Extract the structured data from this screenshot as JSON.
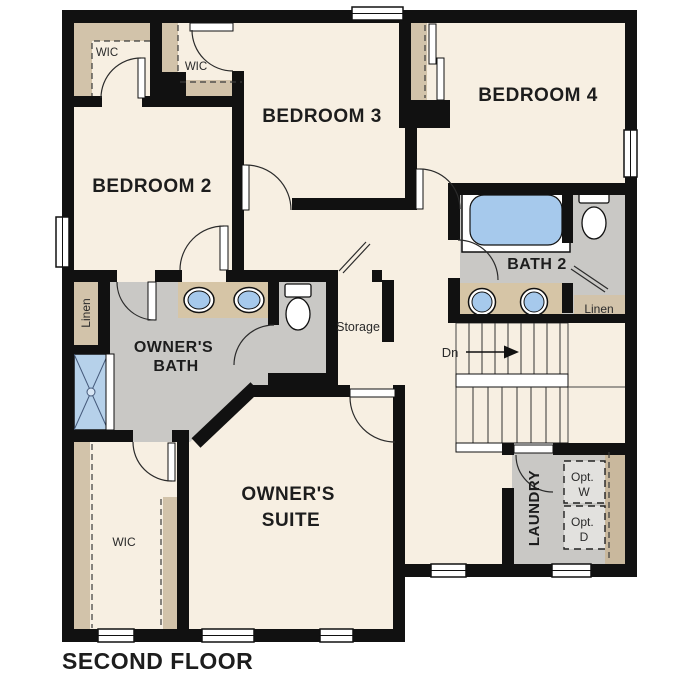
{
  "title": "SECOND FLOOR",
  "rooms": {
    "bedroom2": {
      "label": "BEDROOM 2"
    },
    "bedroom3": {
      "label": "BEDROOM 3"
    },
    "bedroom4": {
      "label": "BEDROOM 4"
    },
    "owners_suite": {
      "line1": "OWNER'S",
      "line2": "SUITE"
    },
    "owners_bath": {
      "line1": "OWNER'S",
      "line2": "BATH"
    },
    "bath2": {
      "label": "BATH 2"
    },
    "laundry": {
      "label": "LAUNDRY"
    },
    "storage": {
      "label": "Storage"
    },
    "wic_bedroom2": {
      "label": "WIC"
    },
    "wic_bedroom3": {
      "label": "WIC"
    },
    "wic_owners": {
      "label": "WIC"
    },
    "linen_owners": {
      "label": "Linen"
    },
    "linen_bath2": {
      "label": "Linen"
    },
    "stairs": {
      "down_label": "Dn"
    },
    "opt_washer": {
      "line1": "Opt.",
      "line2": "W"
    },
    "opt_dryer": {
      "line1": "Opt.",
      "line2": "D"
    }
  },
  "colors": {
    "wall": "#111111",
    "floor_beige": "#f7efe2",
    "wet_area_gray": "#c9c8c5",
    "closet_tan": "#d2c3aa",
    "counter_tan": "#d6c5a6",
    "fixture_blue": "#a6c9ec",
    "shower_blue": "#b6d1ea",
    "label_color": "#1d1d1d"
  }
}
